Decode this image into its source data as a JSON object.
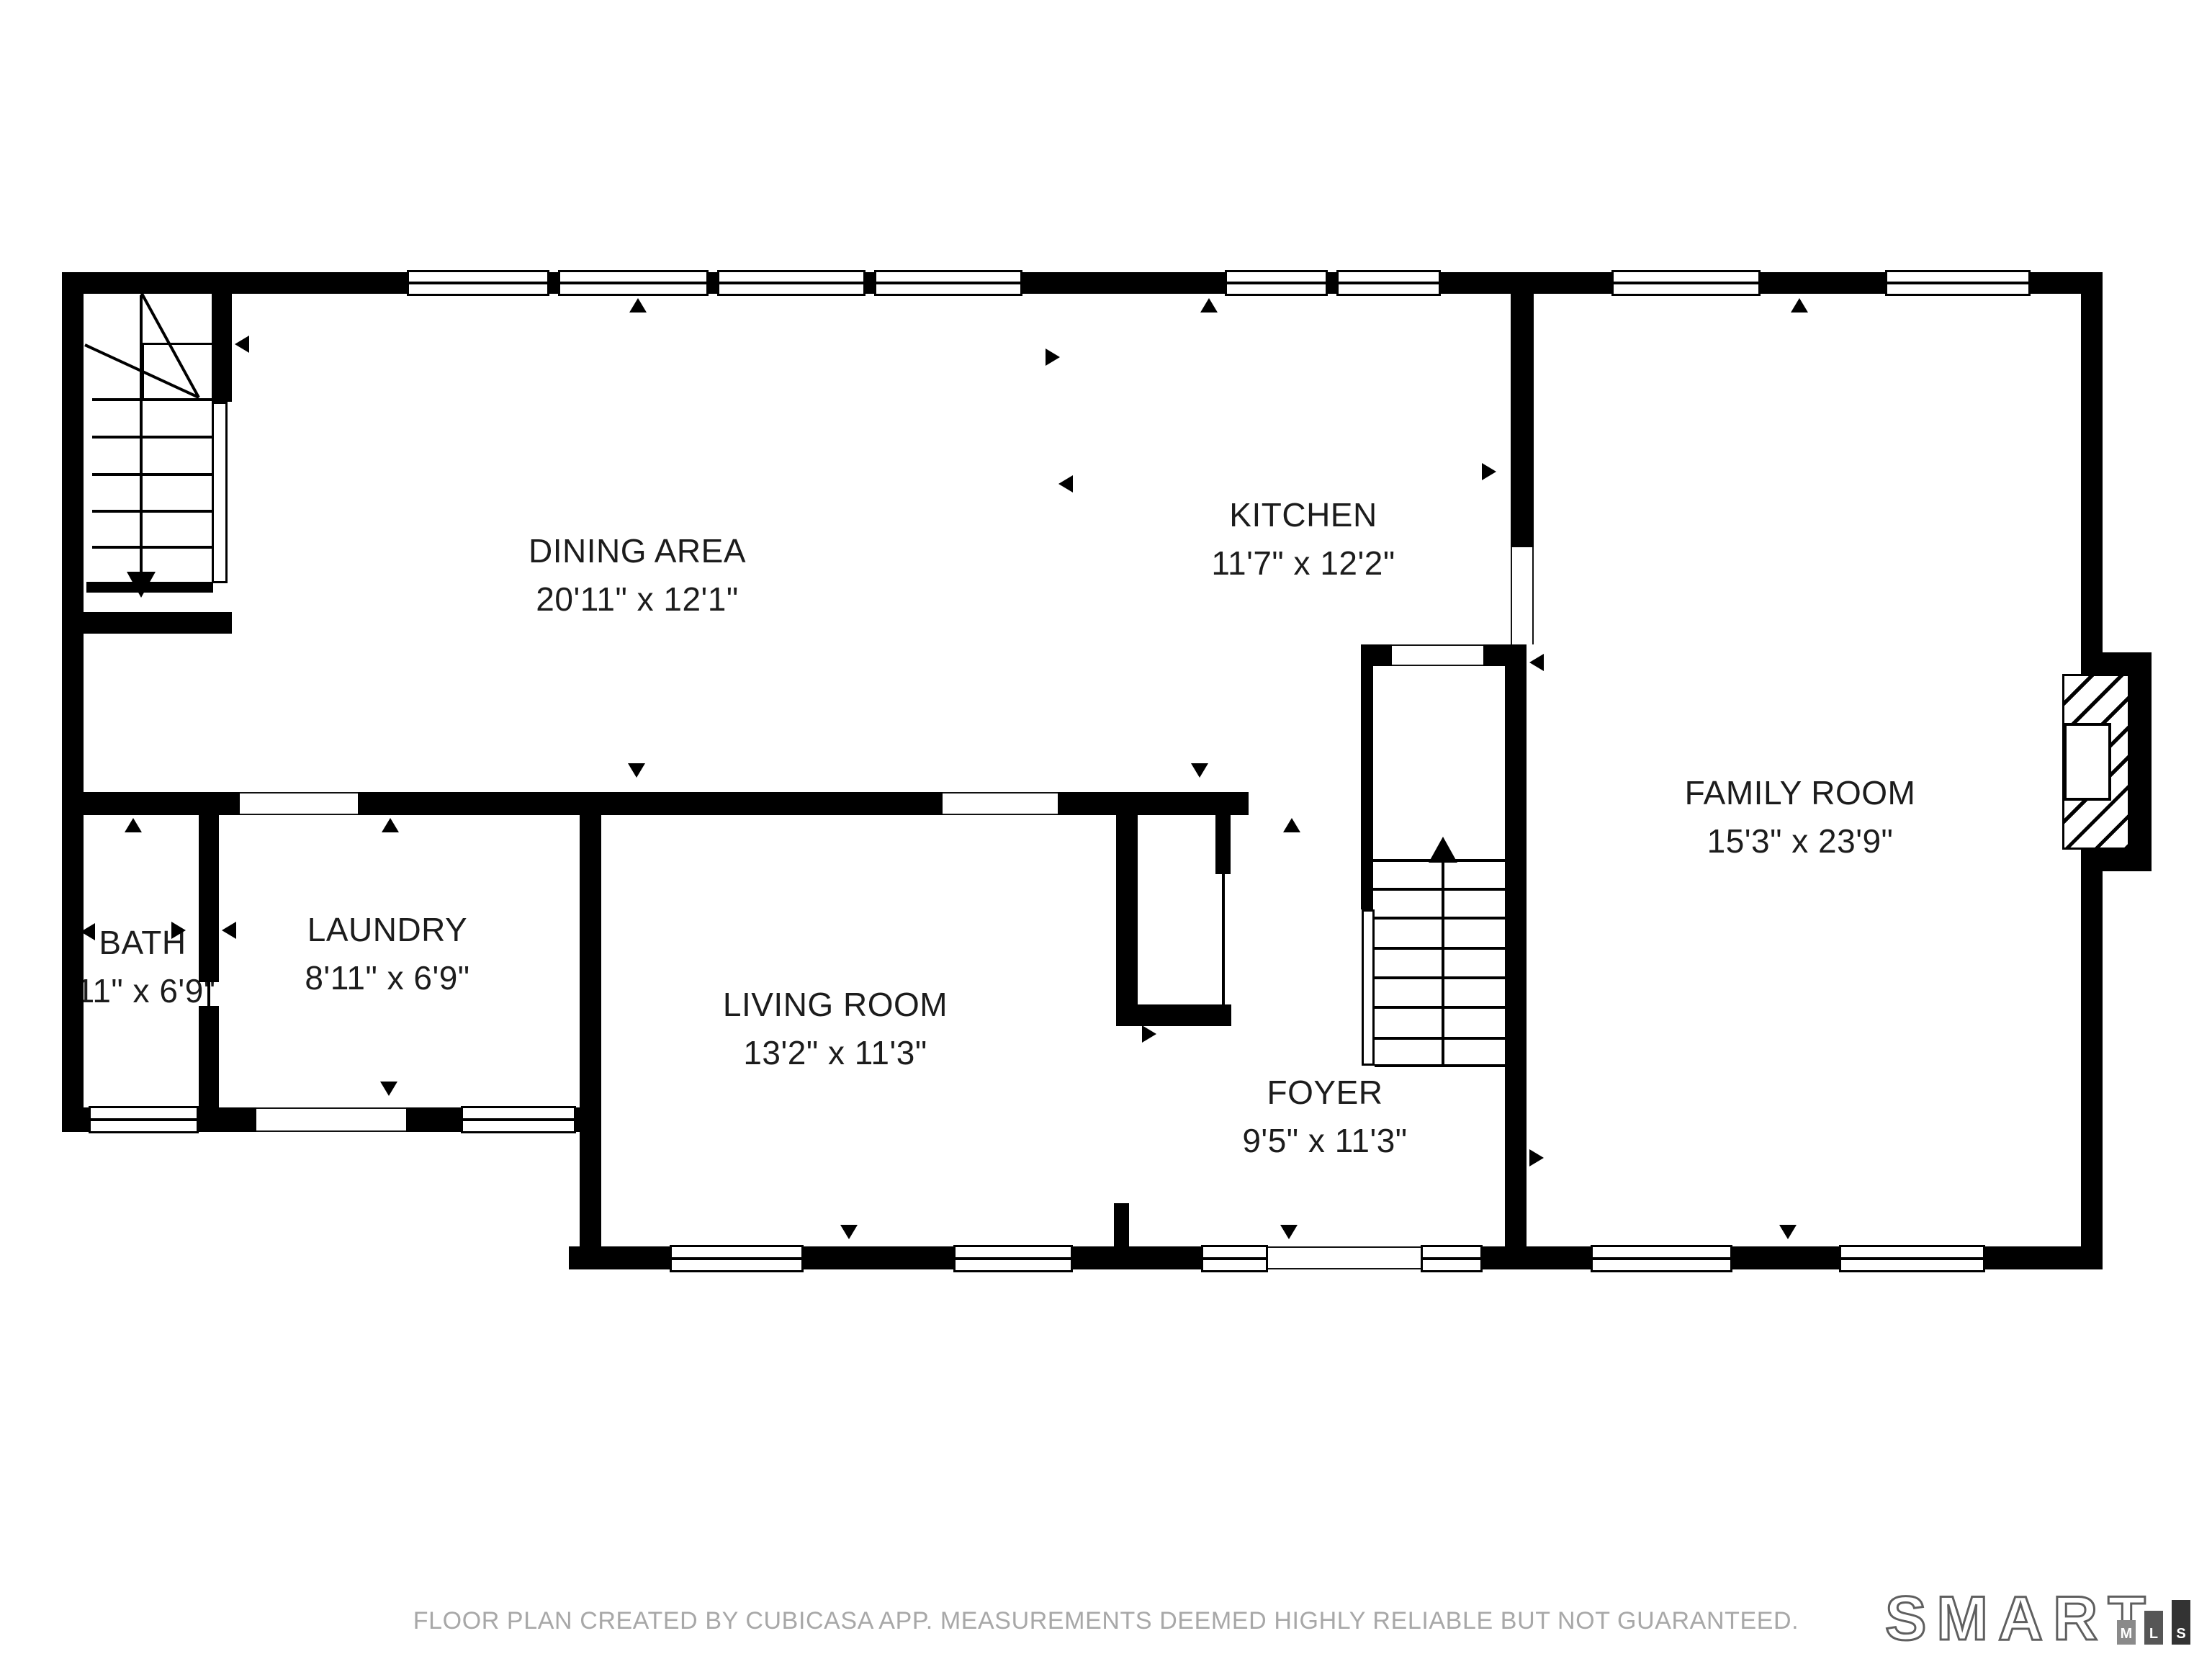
{
  "plan": {
    "rooms": [
      {
        "id": "dining",
        "name": "DINING AREA",
        "dims": "20'11\" x 12'1\""
      },
      {
        "id": "kitchen",
        "name": "KITCHEN",
        "dims": "11'7\" x 12'2\""
      },
      {
        "id": "family",
        "name": "FAMILY ROOM",
        "dims": "15'3\" x 23'9\""
      },
      {
        "id": "living",
        "name": "LIVING ROOM",
        "dims": "13'2\" x 11'3\""
      },
      {
        "id": "foyer",
        "name": "FOYER",
        "dims": "9'5\" x 11'3\""
      },
      {
        "id": "bath",
        "name": "BATH",
        "dims": "'11\" x 6'9\""
      },
      {
        "id": "laundry",
        "name": "LAUNDRY",
        "dims": "8'11\" x 6'9\""
      }
    ]
  },
  "footer": {
    "disclaimer": "FLOOR PLAN CREATED BY CUBICASA APP. MEASUREMENTS DEEMED HIGHLY RELIABLE BUT NOT GUARANTEED."
  },
  "logo": {
    "brand": "SMART",
    "bars": [
      "M",
      "L",
      "S"
    ]
  },
  "colors": {
    "wall": "#000000",
    "label_text": "#1c1c1c",
    "footer_text": "#a8a8a8",
    "logo_outline": "#5f5f5f",
    "bar_m": "#8a8a8a",
    "bar_l": "#565656",
    "bar_s": "#333333"
  }
}
